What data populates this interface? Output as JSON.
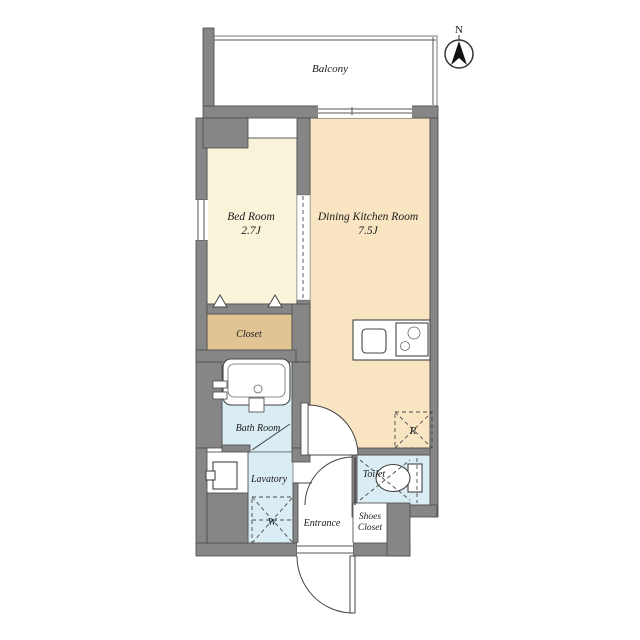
{
  "palette": {
    "wall": "#868686",
    "outline": "#444444",
    "paper": "#ffffff",
    "bedroom_floor": "#f8f3d9",
    "dining_kitchen_floor": "#fae5c3",
    "closet_floor": "#e0c494",
    "wet_area_floor": "#daecf4"
  },
  "compass": {
    "north_label": "N"
  },
  "rooms": {
    "balcony": {
      "label": "Balcony"
    },
    "bed_room": {
      "label": "Bed Room",
      "size": "2.7J"
    },
    "dining_kitchen": {
      "label": "Dining Kitchen Room",
      "size": "7.5J"
    },
    "closet": {
      "label": "Closet"
    },
    "bath_room": {
      "label": "Bath Room"
    },
    "lavatory": {
      "label": "Lavatory"
    },
    "entrance": {
      "label": "Entrance"
    },
    "toilet": {
      "label": "Toilet"
    },
    "shoes_closet": {
      "label_line1": "Shoes",
      "label_line2": "Closet"
    }
  },
  "appliance_spots": {
    "washing_machine": {
      "label": "W"
    },
    "refrigerator": {
      "label": "R"
    }
  }
}
